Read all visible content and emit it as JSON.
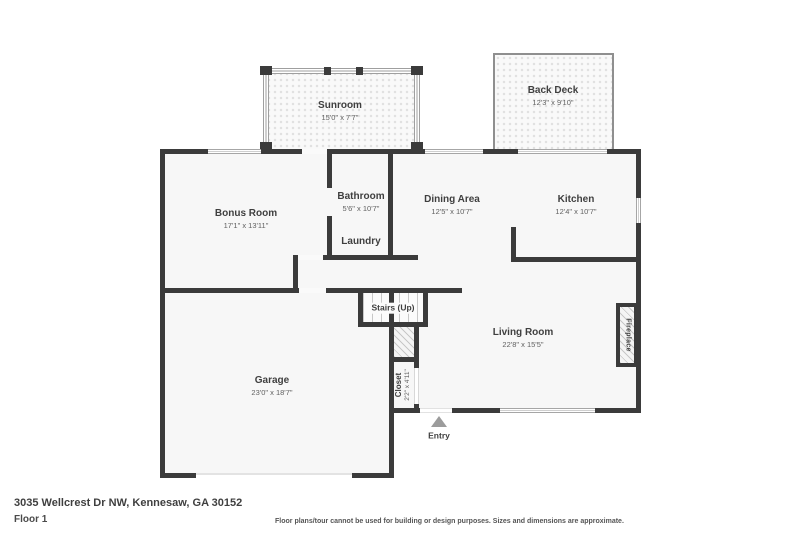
{
  "plan": {
    "address": "3035 Wellcrest Dr NW, Kennesaw, GA 30152",
    "floor_label": "Floor 1",
    "disclaimer": "Floor plans/tour cannot be used for building or design purposes. Sizes and dimensions are approximate."
  },
  "rooms": {
    "sunroom": {
      "name": "Sunroom",
      "dims": "15'0\" x 7'7\""
    },
    "back_deck": {
      "name": "Back Deck",
      "dims": "12'3\" x 9'10\""
    },
    "bonus_room": {
      "name": "Bonus Room",
      "dims": "17'1\" x 13'11\""
    },
    "bathroom": {
      "name": "Bathroom",
      "dims": "5'6\" x 10'7\""
    },
    "laundry": {
      "name": "Laundry"
    },
    "dining_area": {
      "name": "Dining Area",
      "dims": "12'5\" x 10'7\""
    },
    "kitchen": {
      "name": "Kitchen",
      "dims": "12'4\" x 10'7\""
    },
    "living_room": {
      "name": "Living Room",
      "dims": "22'8\" x 15'5\""
    },
    "garage": {
      "name": "Garage",
      "dims": "23'0\" x 18'7\""
    },
    "stairs": {
      "name": "Stairs (Up)"
    },
    "closet": {
      "name": "Closet",
      "dims": "2'2\" x 4'11\""
    },
    "fireplace": {
      "name": "Fireplace"
    },
    "entry": {
      "name": "Entry"
    }
  },
  "colors": {
    "wall": "#3b3b3b",
    "fill": "#f7f7f7",
    "label": "#3f3f3f",
    "dims": "#616161"
  }
}
